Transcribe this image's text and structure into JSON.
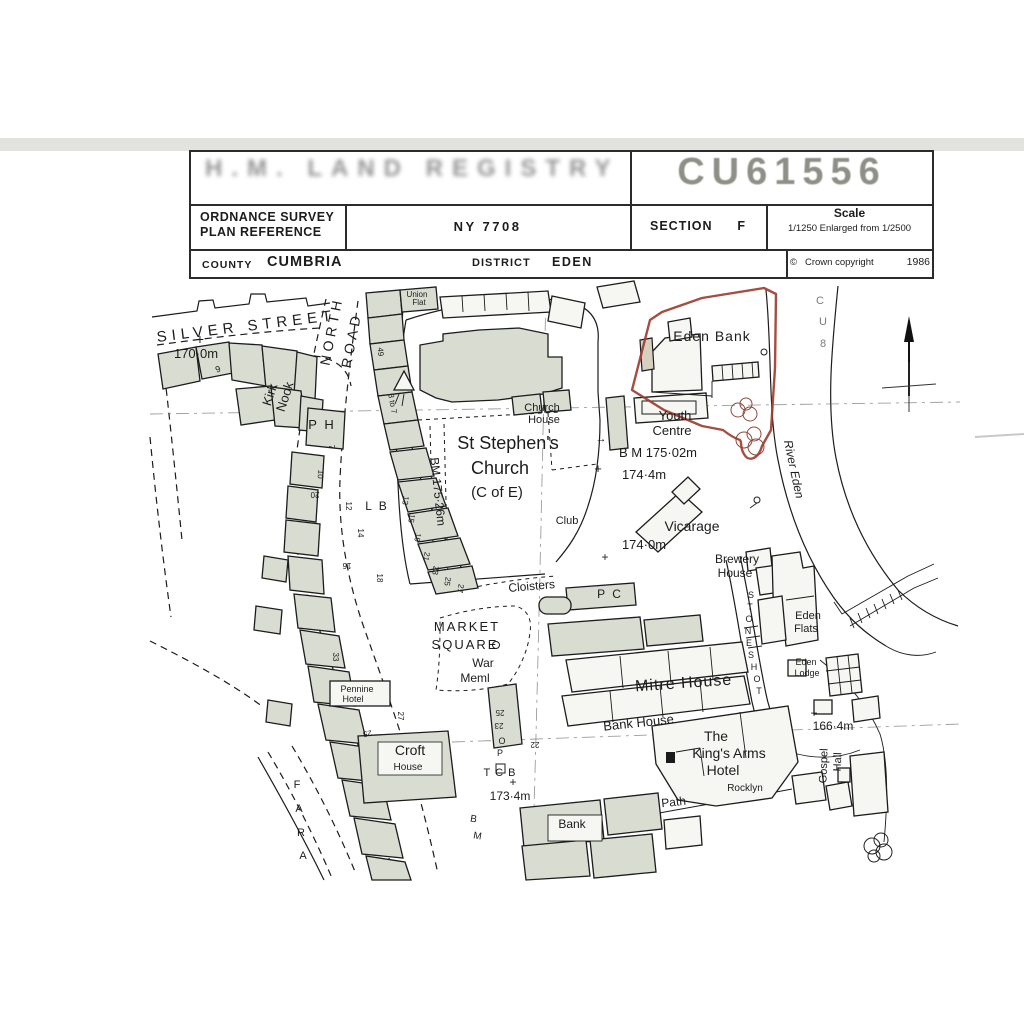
{
  "header": {
    "registry_title": "H.M. LAND REGISTRY",
    "title_number": "CU61556",
    "plan_ref_label_1": "ORDNANCE SURVEY",
    "plan_ref_label_2": "PLAN REFERENCE",
    "plan_ref_value": "NY 7708",
    "section_label": "SECTION",
    "section_value": "F",
    "scale_label": "Scale",
    "scale_value": "1/1250 Enlarged from 1/2500",
    "county_label": "COUNTY",
    "county_value": "CUMBRIA",
    "district_label": "DISTRICT",
    "district_value": "EDEN",
    "copyright_symbol": "©",
    "copyright_text": "Crown copyright",
    "copyright_year": "1986"
  },
  "map": {
    "boundary_property": "Eden Bank",
    "boundary_color": "#9c3a2e",
    "labels": [
      {
        "t": "SILVER STREET",
        "x": 247,
        "y": 331,
        "r": -7,
        "s": 15,
        "ls": 5
      },
      {
        "t": "+",
        "x": 200,
        "y": 344,
        "s": 14
      },
      {
        "t": "170·0m",
        "x": 196,
        "y": 358,
        "s": 13
      },
      {
        "t": "9",
        "x": 219,
        "y": 372,
        "r": -20,
        "s": 9
      },
      {
        "t": "Kirk",
        "x": 274,
        "y": 396,
        "r": -72,
        "s": 13
      },
      {
        "t": "Nook",
        "x": 289,
        "y": 398,
        "r": -72,
        "s": 13
      },
      {
        "t": "NORTH",
        "x": 336,
        "y": 332,
        "r": -79,
        "s": 14,
        "ls": 4
      },
      {
        "t": "ROAD",
        "x": 356,
        "y": 341,
        "r": -79,
        "s": 14,
        "ls": 4
      },
      {
        "t": "Union",
        "x": 417,
        "y": 297,
        "s": 8
      },
      {
        "t": "Flat",
        "x": 419,
        "y": 305,
        "s": 8
      },
      {
        "t": "49",
        "x": 378,
        "y": 352,
        "r": 85,
        "s": 8
      },
      {
        "t": "3 to 7",
        "x": 390,
        "y": 404,
        "r": 80,
        "s": 8
      },
      {
        "t": "P H",
        "x": 322,
        "y": 429,
        "s": 13,
        "ls": 2
      },
      {
        "t": "7",
        "x": 329,
        "y": 447,
        "r": 90,
        "s": 8
      },
      {
        "t": "10",
        "x": 318,
        "y": 474,
        "r": 95,
        "s": 8
      },
      {
        "t": "20",
        "x": 315,
        "y": 492,
        "r": 180,
        "s": 8
      },
      {
        "t": "12",
        "x": 346,
        "y": 506,
        "r": 90,
        "s": 8
      },
      {
        "t": "14",
        "x": 358,
        "y": 533,
        "r": 90,
        "s": 8
      },
      {
        "t": "16",
        "x": 347,
        "y": 563,
        "r": 180,
        "s": 8
      },
      {
        "t": "18",
        "x": 377,
        "y": 578,
        "r": 90,
        "s": 8
      },
      {
        "t": "L B",
        "x": 377,
        "y": 510,
        "s": 12,
        "ls": 2
      },
      {
        "t": "13",
        "x": 403,
        "y": 500,
        "r": 100,
        "s": 8
      },
      {
        "t": "15",
        "x": 409,
        "y": 518,
        "r": 100,
        "s": 8
      },
      {
        "t": "19",
        "x": 415,
        "y": 537,
        "r": 100,
        "s": 8
      },
      {
        "t": "21",
        "x": 424,
        "y": 556,
        "r": 100,
        "s": 8
      },
      {
        "t": "23",
        "x": 433,
        "y": 570,
        "r": 100,
        "s": 8
      },
      {
        "t": "25",
        "x": 445,
        "y": 581,
        "r": 100,
        "s": 8
      },
      {
        "t": "27",
        "x": 458,
        "y": 588,
        "r": 100,
        "s": 8
      },
      {
        "t": "BM 175·26m",
        "x": 434,
        "y": 492,
        "r": 84,
        "s": 12
      },
      {
        "t": "St Stephen's",
        "x": 508,
        "y": 449,
        "s": 18
      },
      {
        "t": "Church",
        "x": 500,
        "y": 474,
        "s": 18
      },
      {
        "t": "(C of E)",
        "x": 497,
        "y": 497,
        "s": 15
      },
      {
        "t": "Church",
        "x": 542,
        "y": 411,
        "s": 11
      },
      {
        "t": "House",
        "x": 544,
        "y": 423,
        "s": 11
      },
      {
        "t": "Club",
        "x": 567,
        "y": 524,
        "s": 11
      },
      {
        "t": "Eden Bank",
        "x": 712,
        "y": 341,
        "s": 14,
        "ls": 1
      },
      {
        "t": "Youth",
        "x": 675,
        "y": 420,
        "s": 13
      },
      {
        "t": "Centre",
        "x": 672,
        "y": 435,
        "s": 13
      },
      {
        "t": "→",
        "x": 601,
        "y": 442,
        "s": 11
      },
      {
        "t": "B M 175·02m",
        "x": 658,
        "y": 457,
        "s": 13
      },
      {
        "t": "+",
        "x": 598,
        "y": 473,
        "s": 13
      },
      {
        "t": "174·4m",
        "x": 644,
        "y": 479,
        "s": 13
      },
      {
        "t": "Vicarage",
        "x": 692,
        "y": 531,
        "s": 14
      },
      {
        "t": "174·0m",
        "x": 644,
        "y": 549,
        "s": 13
      },
      {
        "t": "Brewery",
        "x": 737,
        "y": 563,
        "s": 12
      },
      {
        "t": "House",
        "x": 735,
        "y": 577,
        "s": 12
      },
      {
        "t": "River Eden",
        "x": 790,
        "y": 470,
        "r": 78,
        "s": 12,
        "f": "serif"
      },
      {
        "t": "S",
        "x": 751,
        "y": 598,
        "s": 9
      },
      {
        "t": "T",
        "x": 750,
        "y": 610,
        "s": 9
      },
      {
        "t": "O",
        "x": 749,
        "y": 622,
        "s": 9
      },
      {
        "t": "N",
        "x": 748,
        "y": 634,
        "s": 9
      },
      {
        "t": "E",
        "x": 749,
        "y": 646,
        "s": 9
      },
      {
        "t": "S",
        "x": 751,
        "y": 658,
        "s": 9
      },
      {
        "t": "H",
        "x": 754,
        "y": 670,
        "s": 9
      },
      {
        "t": "O",
        "x": 757,
        "y": 682,
        "s": 9
      },
      {
        "t": "T",
        "x": 759,
        "y": 694,
        "s": 9
      },
      {
        "t": "Eden",
        "x": 808,
        "y": 619,
        "s": 11
      },
      {
        "t": "Flats",
        "x": 806,
        "y": 632,
        "s": 11
      },
      {
        "t": "Eden",
        "x": 806,
        "y": 665,
        "s": 9
      },
      {
        "t": "Lodge",
        "x": 807,
        "y": 676,
        "s": 9
      },
      {
        "t": "Cloisters",
        "x": 532,
        "y": 590,
        "r": -5,
        "s": 12
      },
      {
        "t": "MARKET",
        "x": 467,
        "y": 631,
        "s": 13,
        "ls": 2
      },
      {
        "t": "SQUARE",
        "x": 465,
        "y": 649,
        "s": 13,
        "ls": 2
      },
      {
        "t": "War",
        "x": 483,
        "y": 667,
        "s": 12
      },
      {
        "t": "Meml",
        "x": 475,
        "y": 682,
        "s": 12
      },
      {
        "t": "P C",
        "x": 610,
        "y": 598,
        "s": 12,
        "ls": 2
      },
      {
        "t": "+",
        "x": 605,
        "y": 561,
        "s": 12
      },
      {
        "t": "Mitre House",
        "x": 684,
        "y": 688,
        "r": -4,
        "s": 16,
        "ls": 1
      },
      {
        "t": "Bank House",
        "x": 639,
        "y": 727,
        "r": -6,
        "s": 13
      },
      {
        "t": "The",
        "x": 716,
        "y": 741,
        "s": 14
      },
      {
        "t": "King's Arms",
        "x": 729,
        "y": 758,
        "s": 14
      },
      {
        "t": "Hotel",
        "x": 723,
        "y": 775,
        "s": 14
      },
      {
        "t": "Rocklyn",
        "x": 745,
        "y": 791,
        "s": 10
      },
      {
        "t": "+",
        "x": 814,
        "y": 717,
        "s": 12
      },
      {
        "t": "166·4m",
        "x": 833,
        "y": 730,
        "s": 12
      },
      {
        "t": "Gospel",
        "x": 827,
        "y": 766,
        "r": -88,
        "s": 11
      },
      {
        "t": "Hall",
        "x": 841,
        "y": 762,
        "r": -88,
        "s": 11
      },
      {
        "t": "Path",
        "x": 674,
        "y": 806,
        "r": -6,
        "s": 12
      },
      {
        "t": "Bank",
        "x": 572,
        "y": 828,
        "s": 12
      },
      {
        "t": "25",
        "x": 500,
        "y": 710,
        "r": 180,
        "s": 8
      },
      {
        "t": "23",
        "x": 499,
        "y": 723,
        "r": 180,
        "s": 8
      },
      {
        "t": "O",
        "x": 502,
        "y": 744,
        "s": 9
      },
      {
        "t": "P",
        "x": 500,
        "y": 756,
        "s": 9
      },
      {
        "t": "22",
        "x": 535,
        "y": 742,
        "r": 180,
        "s": 8
      },
      {
        "t": "T C B",
        "x": 500,
        "y": 776,
        "s": 11,
        "ls": 1
      },
      {
        "t": "+",
        "x": 513,
        "y": 786,
        "s": 12
      },
      {
        "t": "173·4m",
        "x": 510,
        "y": 800,
        "s": 12
      },
      {
        "t": "B",
        "x": 473,
        "y": 822,
        "r": 10,
        "s": 10
      },
      {
        "t": "M",
        "x": 477,
        "y": 839,
        "r": 10,
        "s": 10
      },
      {
        "t": "F",
        "x": 297,
        "y": 788,
        "s": 11
      },
      {
        "t": "A",
        "x": 299,
        "y": 812,
        "s": 11
      },
      {
        "t": "R",
        "x": 301,
        "y": 836,
        "s": 11
      },
      {
        "t": "A",
        "x": 303,
        "y": 859,
        "s": 11
      },
      {
        "t": "33",
        "x": 333,
        "y": 657,
        "r": 90,
        "s": 8
      },
      {
        "t": "25",
        "x": 367,
        "y": 731,
        "r": 170,
        "s": 8
      },
      {
        "t": "27",
        "x": 398,
        "y": 716,
        "r": 90,
        "s": 8
      },
      {
        "t": "Pennine",
        "x": 357,
        "y": 692,
        "s": 9
      },
      {
        "t": "Hotel",
        "x": 353,
        "y": 702,
        "s": 9
      },
      {
        "t": "Croft",
        "x": 410,
        "y": 755,
        "s": 14
      },
      {
        "t": "House",
        "x": 408,
        "y": 770,
        "s": 10
      },
      {
        "t": "C",
        "x": 820,
        "y": 304,
        "s": 11,
        "c": "#8b8b88",
        "o": 0.6
      },
      {
        "t": "U",
        "x": 823,
        "y": 325,
        "s": 11,
        "c": "#8b8b88",
        "o": 0.6
      },
      {
        "t": "8",
        "x": 823,
        "y": 347,
        "s": 11,
        "c": "#8b8b88",
        "o": 0.6
      }
    ]
  }
}
